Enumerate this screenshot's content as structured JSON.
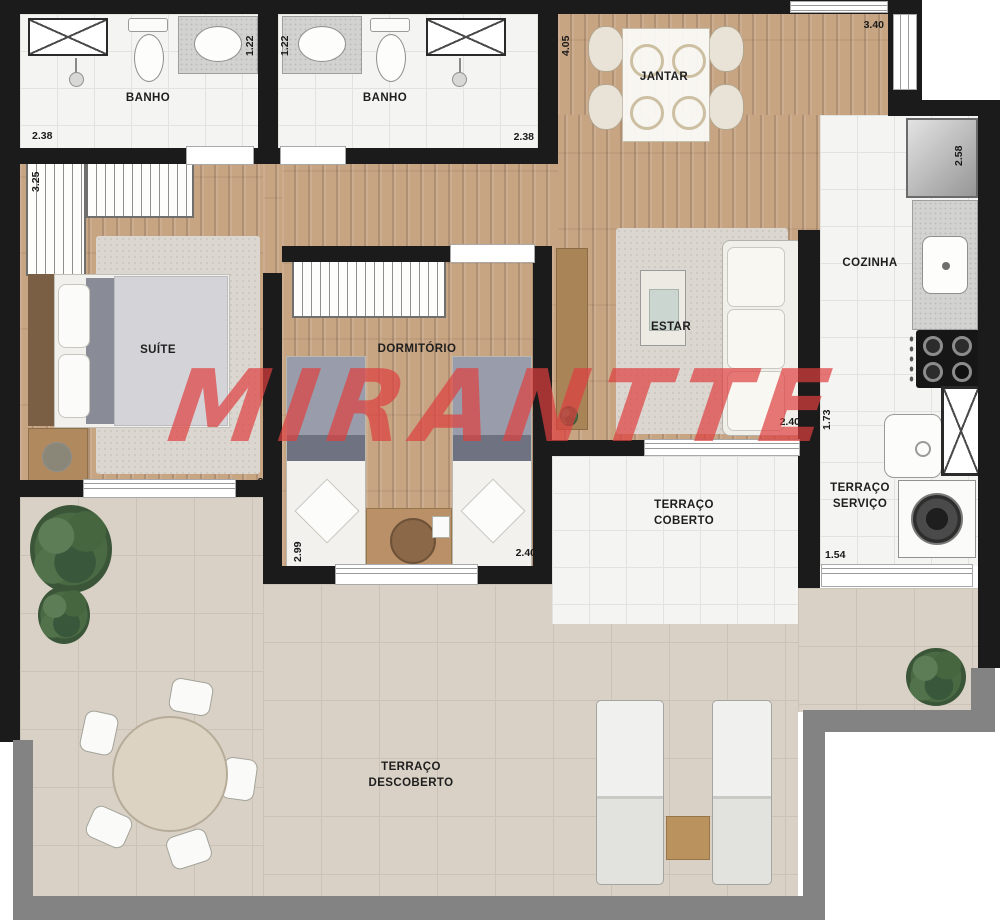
{
  "watermark": {
    "text": "MIRANTTE",
    "color": "#de3e3e"
  },
  "rooms": {
    "banho1": {
      "label": "BANHO"
    },
    "banho2": {
      "label": "BANHO"
    },
    "jantar": {
      "label": "JANTAR"
    },
    "cozinha": {
      "label": "COZINHA"
    },
    "suite": {
      "label": "SUÍTE"
    },
    "dormitorio": {
      "label": "DORMITÓRIO"
    },
    "estar": {
      "label": "ESTAR"
    },
    "terraco_coberto": {
      "lines": [
        "TERRAÇO",
        "COBERTO"
      ]
    },
    "terraco_servico": {
      "lines": [
        "TERRAÇO",
        "SERVIÇO"
      ]
    },
    "terraco_descoberto": {
      "lines": [
        "TERRAÇO",
        "DESCOBERTO"
      ]
    }
  },
  "dimensions": {
    "banho1_width": "2.38",
    "banho1_depth": "1.22",
    "banho2_depth": "1.22",
    "banho2_width": "2.38",
    "jantar_depth": "4.05",
    "jantar_width": "3.40",
    "cozinha_depth": "2.58",
    "suite_depth": "3.25",
    "suite_width": "2.40",
    "dormitorio_depth": "2.99",
    "dormitorio_width": "2.40",
    "estar_width": "2.40",
    "servico_depth": "1.73",
    "servico_width": "1.54"
  },
  "colors": {
    "wall": "#1b1b1b",
    "wood_floor": "#c7a482",
    "white_tile": "#f4f4f2",
    "terrace_beige": "#d9d1c5",
    "parapet_gray": "#838383",
    "watermark_red": "#de3e3e"
  }
}
